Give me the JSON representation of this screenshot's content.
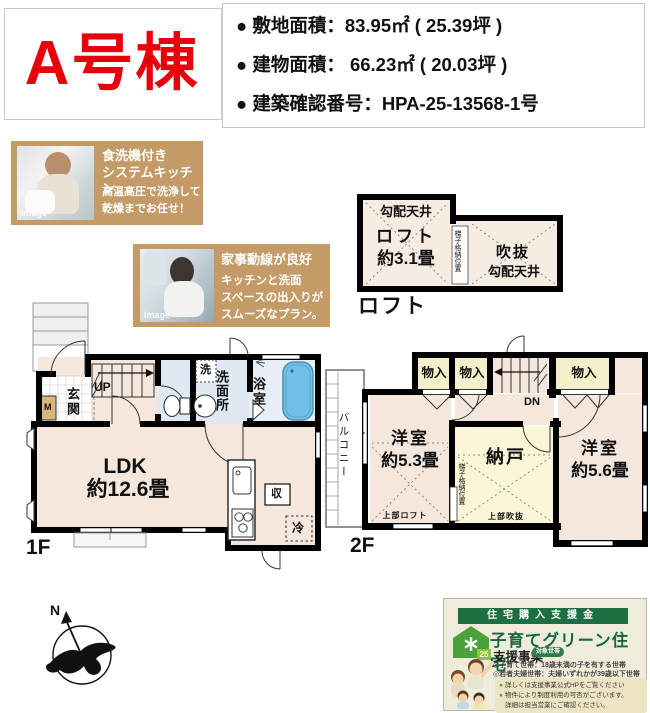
{
  "header": {
    "unit_label": "A号棟",
    "lines": [
      "● 敷地面積：83.95㎡ ( 25.39坪 )",
      "● 建物面積： 66.23㎡ ( 20.03坪 )",
      "● 建築確認番号：HPA-25-13568-1号"
    ],
    "accent_color": "#e8000d"
  },
  "cards": {
    "dishwasher": {
      "image_label": "Image",
      "title1": "食洗機付き",
      "title2": "システムキッチン",
      "body1": "高温高圧で洗浄して",
      "body2": "乾燥までお任せ！"
    },
    "flow": {
      "image_label": "Image",
      "title": "家事動線が良好",
      "body1": "キッチンと洗面",
      "body2": "スペースの出入りが",
      "body3": "スムーズなプラン。"
    }
  },
  "floorplан_note": "",
  "loft": {
    "floor_label": "ロフト",
    "sloped_ceiling_left": "勾配天井",
    "room": "ロフト",
    "size": "約3.1畳",
    "ladder": "梯子格納位置",
    "void": "吹抜",
    "sloped_ceiling_right": "勾配天井"
  },
  "f1": {
    "floor_label": "1F",
    "entrance": "玄関",
    "meter": "M",
    "up": "UP",
    "wash_machine": "洗",
    "washroom": "洗面所",
    "bath": "浴室",
    "ldk": "LDK",
    "ldk_size": "約12.6畳",
    "storage": "収",
    "fridge": "冷"
  },
  "f2": {
    "floor_label": "2F",
    "balcony": "バルコニー",
    "closet": "物入",
    "dn": "DN",
    "room1": "洋室",
    "room1_size": "約5.3畳",
    "room1_note": "上部ロフト",
    "storage_room": "納戸",
    "storage_note": "上部吹抜",
    "ladder": "梯子格納位置",
    "room2": "洋室",
    "room2_size": "約5.6畳"
  },
  "compass": {
    "north": "N"
  },
  "banner": {
    "header": "住宅購入支援金",
    "title": "子育てグリーン住宅",
    "subtitle": "支援事業",
    "badge": "対象世帯",
    "icon_year": "25",
    "cond1": "◎子育て世帯：18歳未満の子を有する世帯",
    "cond2": "◎若者夫婦世帯：夫婦いずれかが39歳以下世帯",
    "notes": [
      {
        "b": "●",
        "t": "詳しくは支援事業公式HPをご覧ください"
      },
      {
        "b": "●",
        "t": "物件により制度利用の可否がございます。"
      },
      {
        "b": "",
        "t": "詳細は担当営業にご確認ください。"
      }
    ]
  }
}
